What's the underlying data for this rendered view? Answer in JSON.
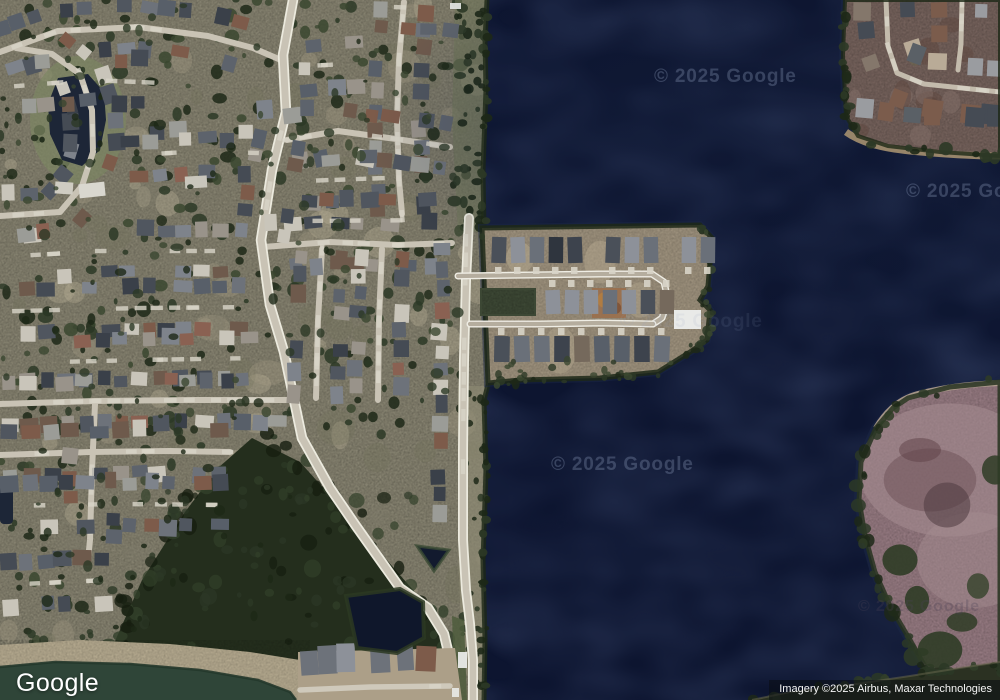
{
  "map": {
    "provider_logo": "Google",
    "attribution": "Imagery ©2025 Airbus, Maxar Technologies",
    "watermark": "© 2025 Google",
    "colors": {
      "water": "#0d1530",
      "water_light": "#141f3c",
      "water_shallow": "#1a2644",
      "land": "#84806e",
      "land_light": "#a89e88",
      "land_olive": "#6f7258",
      "road": "#c9c3b5",
      "road_edge": "#eceade",
      "forest": "#242e1d",
      "forest_light": "#32402a",
      "forest_dark": "#161e10",
      "tree": "#2c3826",
      "tree_dark": "#1d2817",
      "tree_olive": "#39462f",
      "shore_grass": "#6d7558",
      "peninsula_dirt": "#9a8e7a",
      "peninsula_dirt_light": "#b6a990",
      "basin_green": "#3c4734",
      "construction": "#9a6f4c",
      "corner_ground": "#73605a",
      "corner_patch": "#5d443c",
      "island": "#92777e",
      "island_light": "#a48b8f",
      "island_dark": "#6b4f56",
      "island_shore": "#b3a18f",
      "pond_green": "#2f4538",
      "pond_dark": "#1d2637",
      "median_green": "#4e5c3c",
      "dirt_tan": "#b1a68c",
      "driveway": "#d8d4c8",
      "white_roof": "#e9eae8",
      "roof_palette": [
        "#50565f",
        "#454b54",
        "#5d636c",
        "#6d727a",
        "#7e838b",
        "#99938a",
        "#6e5a4c",
        "#7d5b4a",
        "#8a6152",
        "#9b9c97",
        "#c9c5ba",
        "#3a4049",
        "#585f69"
      ]
    }
  }
}
